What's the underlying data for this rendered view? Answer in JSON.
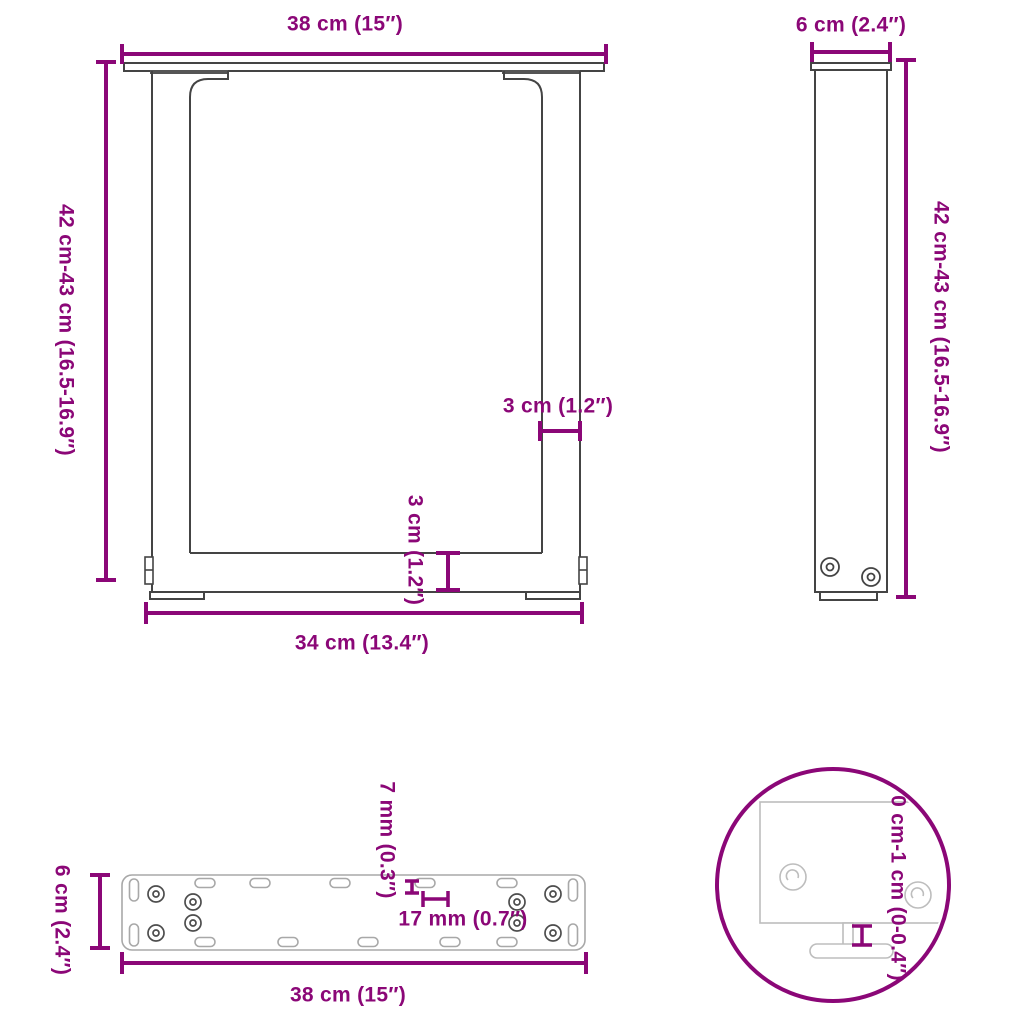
{
  "title": "table-leg-dimension-diagram",
  "colors": {
    "accent": "#8B0777",
    "line_dark": "#444444",
    "line_gray": "#A8A8A8",
    "line_light": "#BDBDBD",
    "background": "#FFFFFF"
  },
  "front_view": {
    "name": "u-shaped-leg-front-view",
    "width_top": "38 cm (15″)",
    "height": "42 cm-43 cm (16.5-16.9″)",
    "leg_width": "3 cm (1.2″)",
    "crossbar_height": "3 cm (1.2″)",
    "width_inner": "34 cm (13.4″)"
  },
  "side_view": {
    "name": "leg-side-view",
    "width": "6 cm (2.4″)",
    "height": "42 cm-43 cm (16.5-16.9″)"
  },
  "plate_view": {
    "name": "mounting-plate-top-view",
    "hole_diameter": "7 mm (0.3″)",
    "hole_spacing": "17 mm (0.7″)",
    "width": "6 cm (2.4″)",
    "length": "38 cm (15″)"
  },
  "detail_view": {
    "name": "adjustable-foot-detail",
    "height_adjustment": "0 cm-1 cm (0-0.4″)"
  }
}
